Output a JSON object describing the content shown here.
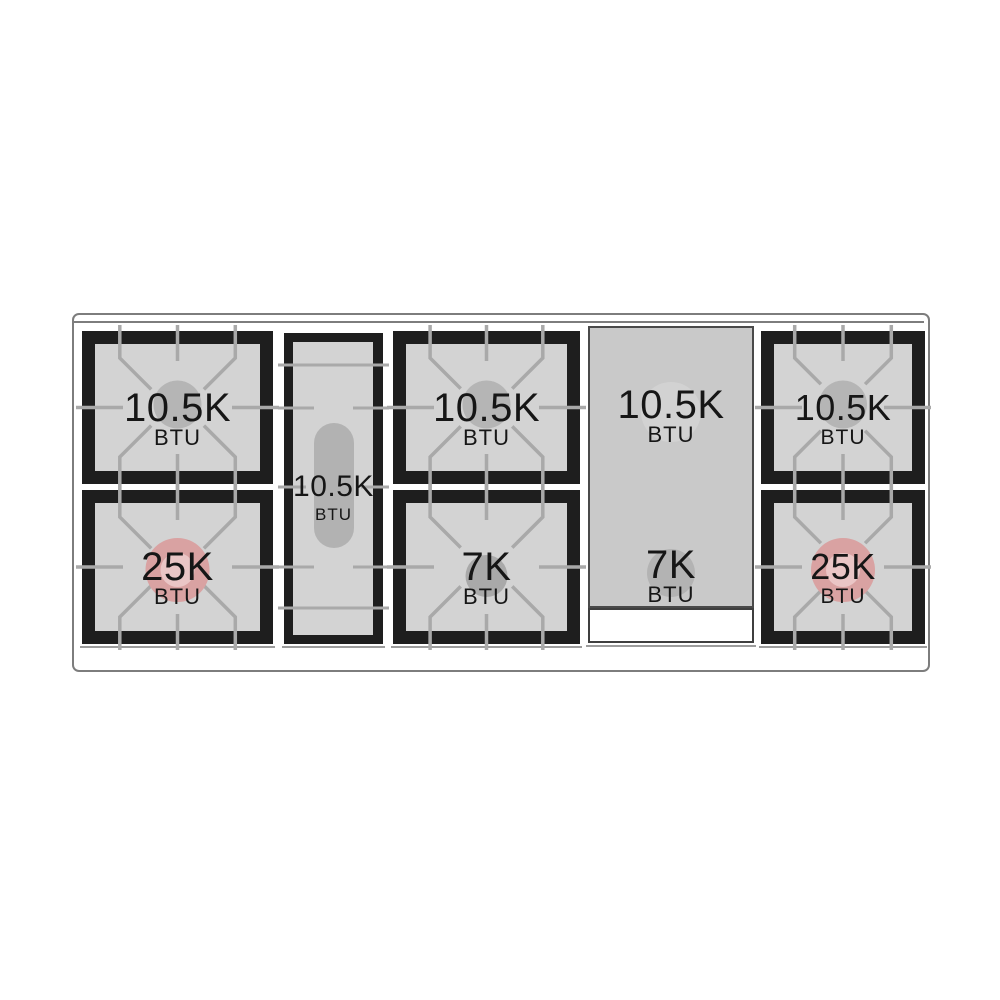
{
  "burners": {
    "left_top": {
      "rating": "10.5K",
      "unit": "BTU"
    },
    "left_bottom": {
      "rating": "25K",
      "unit": "BTU"
    },
    "oval": {
      "rating": "10.5K",
      "unit": "BTU"
    },
    "mid_top": {
      "rating": "10.5K",
      "unit": "BTU"
    },
    "mid_bottom": {
      "rating": "7K",
      "unit": "BTU"
    },
    "griddle_top": {
      "rating": "10.5K",
      "unit": "BTU"
    },
    "griddle_bottom": {
      "rating": "7K",
      "unit": "BTU"
    },
    "right_top": {
      "rating": "10.5K",
      "unit": "BTU"
    },
    "right_bottom": {
      "rating": "25K",
      "unit": "BTU"
    }
  },
  "colors": {
    "frame_black": "#1e1e1e",
    "surface_gray": "#d3d3d3",
    "grate_line_gray": "#a9a9a9",
    "burner_cap_gray": "#b5b5b5",
    "power_burner_pink": "#d9a2a2",
    "power_burner_inner_pink": "#eac6c6",
    "simmer_cap_gray": "#a9a9a9",
    "griddle_gray": "#c9c9c9",
    "griddle_circle_light": "#d2d2d2",
    "griddle_circle_dark": "#b3b3b3",
    "outline_gray": "#7d7d7d",
    "label_black": "#161616"
  }
}
